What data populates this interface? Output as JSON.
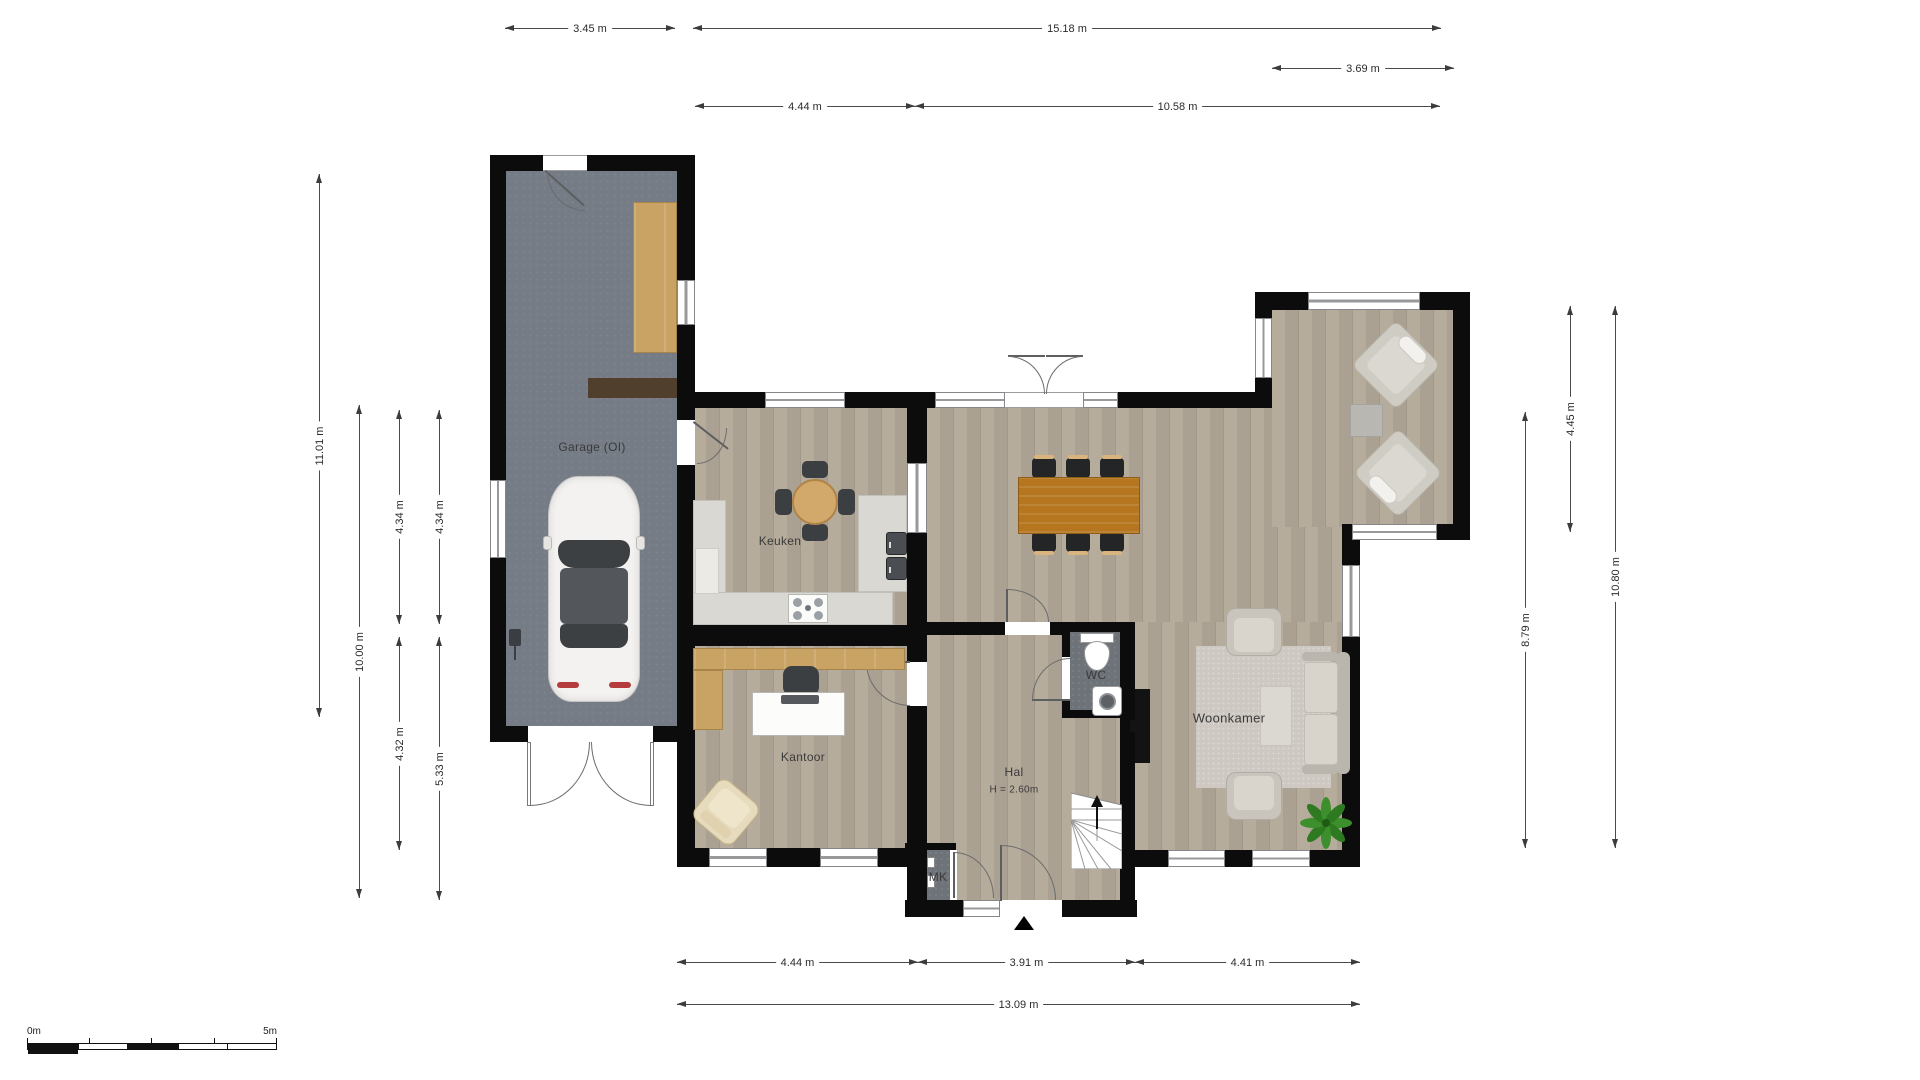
{
  "rooms": {
    "garage": "Garage (OI)",
    "keuken": "Keuken",
    "kantoor": "Kantoor",
    "hal": "Hal",
    "hal_ceiling": "H = 2.60m",
    "wc": "WC",
    "mk": "MK",
    "woonkamer": "Woonkamer"
  },
  "dimensions": {
    "top_345": "3.45 m",
    "top_1518": "15.18 m",
    "top_369": "3.69 m",
    "top_444": "4.44 m",
    "top_1058": "10.58 m",
    "left_1101": "11.01 m",
    "left_1000": "10.00 m",
    "left_434_upper": "4.34 m",
    "left_432": "4.32 m",
    "left_434b_upper": "4.34 m",
    "left_533": "5.33 m",
    "right_445": "4.45 m",
    "right_879": "8.79 m",
    "right_1080": "10.80 m",
    "bottom_444": "4.44 m",
    "bottom_391": "3.91 m",
    "bottom_441": "4.41 m",
    "bottom_1309": "13.09 m"
  },
  "scale_bar": {
    "start": "0m",
    "end": "5m"
  },
  "colors": {
    "wall": "#0c0c0c",
    "wood_floor": "#b2a897",
    "garage_floor": "#757c85",
    "dark_floor": "#6d7378",
    "counter": "#d9d8d3",
    "cabinet_tan": "#c9a364",
    "dining_table_wood": "#b5761f",
    "kitchen_table_wood": "#d2a86b",
    "rug": "#cdc8c1",
    "sofa": "#c9c5bd",
    "plant_green": "#3a8a2e",
    "taillight_red": "#b43c3c"
  }
}
